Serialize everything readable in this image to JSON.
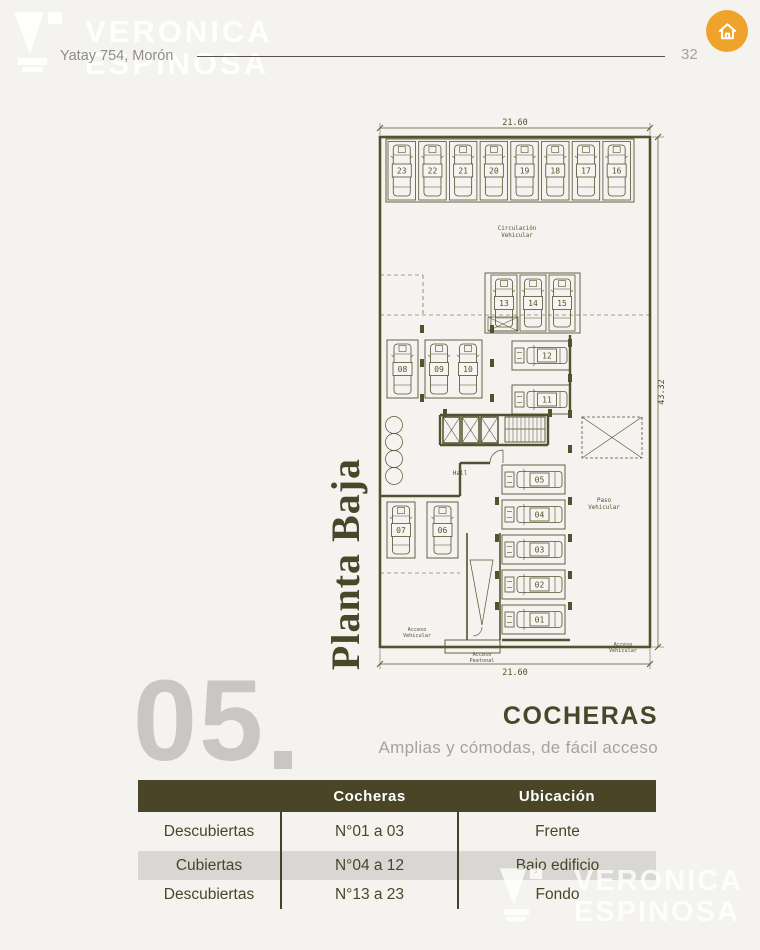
{
  "page": {
    "background": "#f4f3ef",
    "address": "Yatay 754, Morón",
    "number": "32"
  },
  "brand": {
    "line1": "VERONICA",
    "line2": "ESPINOSA"
  },
  "home_button": {
    "color": "#f0a32b",
    "icon": "home-icon"
  },
  "plan": {
    "title": "Planta Baja",
    "line_color": "#55512e",
    "dimensions": {
      "top": "21.60",
      "right": "43.32",
      "bottom": "21.60"
    },
    "zone_labels": {
      "circulacion": [
        "Circulación",
        "Vehicular"
      ],
      "hall": "Hall",
      "paso": [
        "Paso",
        "Vehicular"
      ],
      "acceso_left": [
        "Acceso",
        "Vehicular"
      ],
      "acceso_center": [
        "Acceso",
        "Peatonal"
      ],
      "acceso_right": [
        "Acceso",
        "Vehicular"
      ]
    },
    "spots": {
      "top_row": [
        "23",
        "22",
        "21",
        "20",
        "19",
        "18",
        "17",
        "16"
      ],
      "middle_row": [
        "13",
        "14",
        "15"
      ],
      "left_upper": [
        "08",
        "09",
        "10"
      ],
      "right_upper": [
        "12",
        "11"
      ],
      "left_lower": [
        "07",
        "06"
      ],
      "right_lower": [
        "05",
        "04",
        "03",
        "02",
        "01"
      ]
    }
  },
  "section": {
    "number": "05",
    "number_suffix": ".",
    "title": "COCHERAS",
    "subtitle": "Amplias y cómodas, de fácil acceso"
  },
  "table": {
    "header_bg": "#4a4527",
    "row_alt_bg": "#d8d7d3",
    "text_color": "#4a4527",
    "headers": [
      "",
      "Cocheras",
      "Ubicación"
    ],
    "col_widths": [
      143,
      177,
      198
    ],
    "rows": [
      [
        "Descubiertas",
        "N°01 a 03",
        "Frente"
      ],
      [
        "Cubiertas",
        "N°04 a 12",
        "Bajo edificio"
      ],
      [
        "Descubiertas",
        "N°13 a 23",
        "Fondo"
      ]
    ]
  }
}
